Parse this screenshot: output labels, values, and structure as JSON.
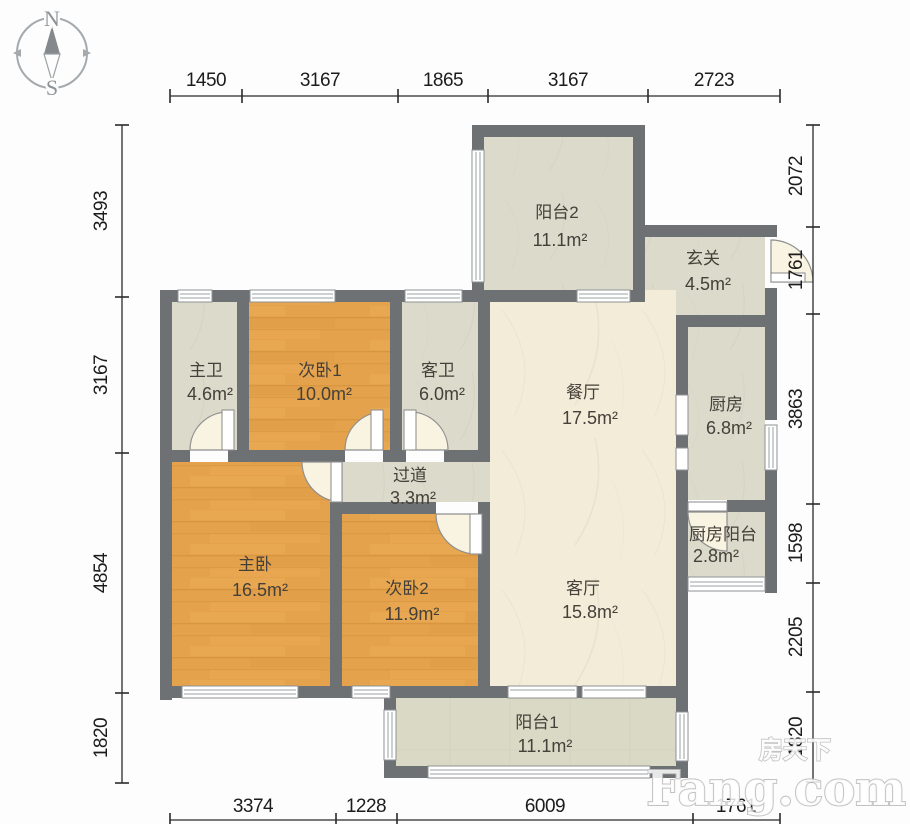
{
  "compass": {
    "north": "N",
    "south": "S"
  },
  "rooms": [
    {
      "id": "balcony2",
      "name": "阳台2",
      "area": "11.1m²"
    },
    {
      "id": "entry",
      "name": "玄关",
      "area": "4.5m²"
    },
    {
      "id": "master-bath",
      "name": "主卫",
      "area": "4.6m²"
    },
    {
      "id": "bedroom1",
      "name": "次卧1",
      "area": "10.0m²"
    },
    {
      "id": "guest-bath",
      "name": "客卫",
      "area": "6.0m²"
    },
    {
      "id": "dining",
      "name": "餐厅",
      "area": "17.5m²"
    },
    {
      "id": "kitchen",
      "name": "厨房",
      "area": "6.8m²"
    },
    {
      "id": "corridor",
      "name": "过道",
      "area": "3.3m²"
    },
    {
      "id": "master-bedroom",
      "name": "主卧",
      "area": "16.5m²"
    },
    {
      "id": "bedroom2",
      "name": "次卧2",
      "area": "11.9m²"
    },
    {
      "id": "living",
      "name": "客厅",
      "area": "15.8m²"
    },
    {
      "id": "kitchen-balcony",
      "name": "厨房阳台",
      "area": "2.8m²"
    },
    {
      "id": "balcony1",
      "name": "阳台1",
      "area": "11.1m²"
    }
  ],
  "dimensions": {
    "top": [
      "1450",
      "3167",
      "1865",
      "3167",
      "2723"
    ],
    "left": [
      "3493",
      "3167",
      "4854",
      "1820"
    ],
    "right": [
      "2072",
      "1761",
      "3863",
      "1598",
      "2205",
      "1820"
    ],
    "bottom": [
      "3374",
      "1228",
      "6009",
      "1761"
    ]
  },
  "watermark": {
    "brand_cn": "房天下",
    "brand_en": "Fang.com"
  },
  "colors": {
    "wall": "#6d7174",
    "bedroom_floor": "#e3a24b",
    "living_floor": "#f2ecd9",
    "service_floor": "#dcdacb",
    "balcony_floor": "#d9d9c5",
    "dimension_text": "#1c1c1c",
    "label_text": "#45403a"
  }
}
